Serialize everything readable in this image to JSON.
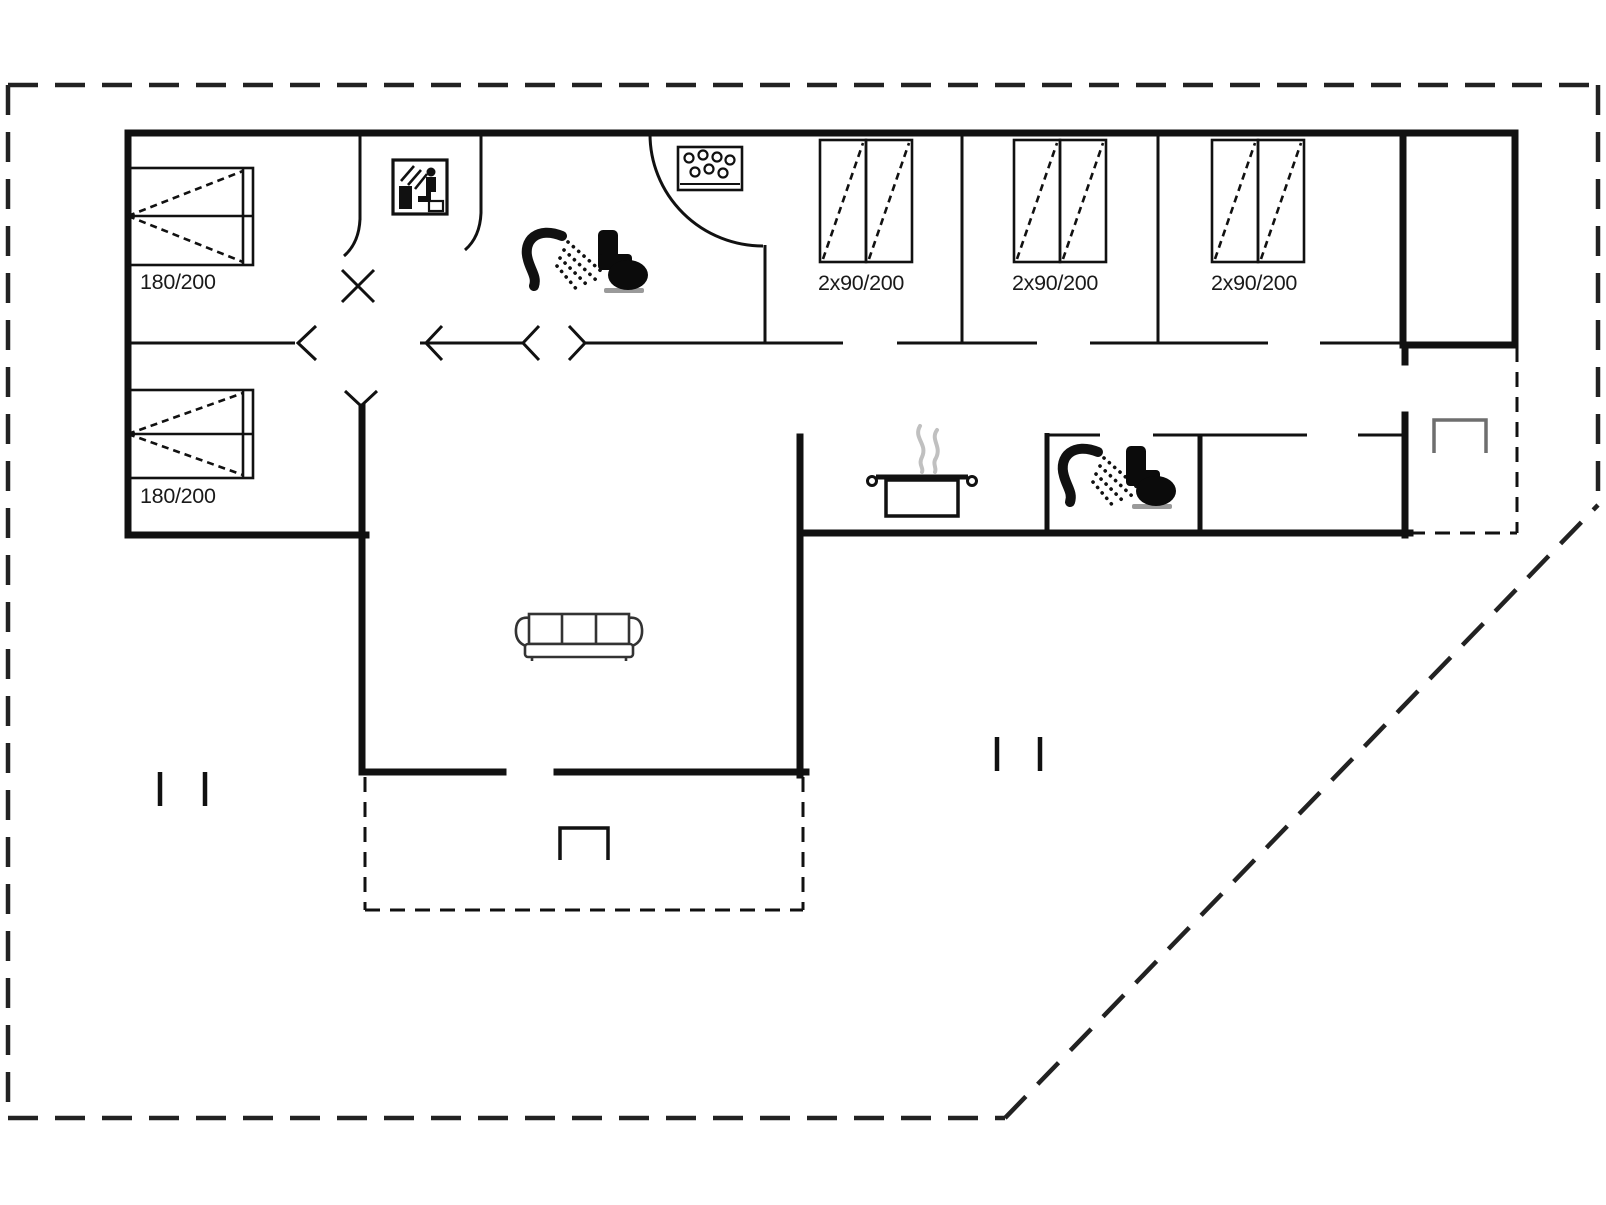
{
  "floor_plan": {
    "type": "holiday-house-ground-plan",
    "background": "#ffffff",
    "wall_color": "#111111",
    "boundary_color": "#222222",
    "steam_color": "#c0c0c0",
    "step_color_main": "#111111",
    "step_color_side": "#6e6e6e",
    "rooms": {
      "bedroom_left_top": {
        "bed_type": "double-bed",
        "bed_label": "180/200"
      },
      "bedroom_left_bottom": {
        "bed_type": "double-bed",
        "bed_label": "180/200"
      },
      "bunk_room_1": {
        "bed_type": "bunk-beds",
        "bed_label": "2x90/200"
      },
      "bunk_room_2": {
        "bed_type": "bunk-beds",
        "bed_label": "2x90/200"
      },
      "bunk_room_3": {
        "bed_type": "bunk-beds",
        "bed_label": "2x90/200"
      },
      "bathroom_top": {
        "fixtures": [
          "shower-icon",
          "toilet-icon",
          "whirlpool-icon",
          "door-arc"
        ]
      },
      "sauna_room": {
        "fixtures": [
          "sauna-icon"
        ]
      },
      "kitchen": {
        "fixtures": [
          "cooking-pot-icon"
        ]
      },
      "bathroom_middle": {
        "fixtures": [
          "shower-icon",
          "toilet-icon"
        ]
      },
      "living_room": {
        "fixtures": [
          "sofa-icon"
        ]
      },
      "terrace_main": {
        "fixtures": [
          "step-icon"
        ]
      },
      "terrace_side": {
        "fixtures": [
          "step-icon"
        ]
      }
    }
  }
}
